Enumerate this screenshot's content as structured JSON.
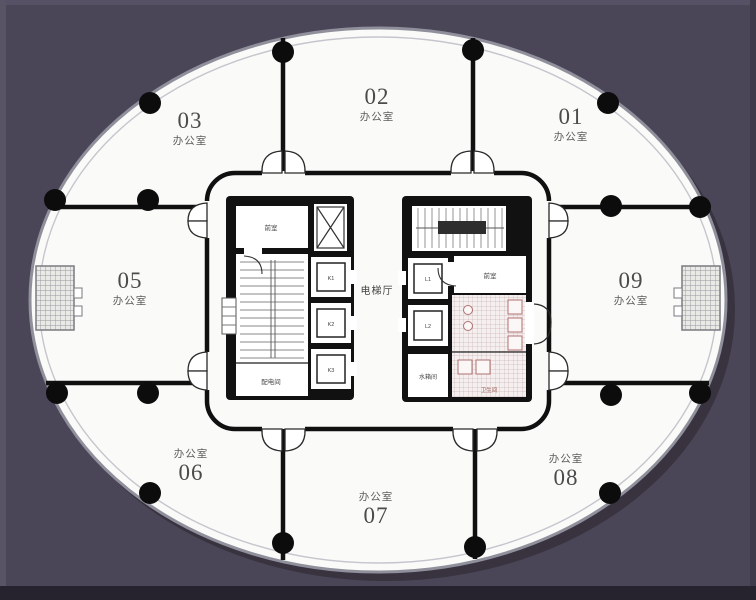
{
  "plan": {
    "rooms": [
      {
        "number": "01",
        "type_label": "办公室"
      },
      {
        "number": "02",
        "type_label": "办公室"
      },
      {
        "number": "03",
        "type_label": "办公室"
      },
      {
        "number": "05",
        "type_label": "办公室"
      },
      {
        "number": "06",
        "type_label": "办公室"
      },
      {
        "number": "07",
        "type_label": "办公室"
      },
      {
        "number": "08",
        "type_label": "办公室"
      },
      {
        "number": "09",
        "type_label": "办公室"
      }
    ],
    "core": {
      "elevator_hall_label": "电梯厅",
      "front_room_left_label": "前室",
      "front_room_right_label": "前室",
      "electrical_room_label": "配电间",
      "water_tank_room_label": "水箱间",
      "toilet_label": "卫生间",
      "left_lift_labels": [
        "K1",
        "K2",
        "K3"
      ],
      "right_lift_labels": [
        "L1",
        "L2"
      ]
    },
    "colors": {
      "background": "#4a4557",
      "floor": "#fafaf8",
      "wall": "#111111",
      "edge_ring": "#90909c",
      "column": "#0c0c0c",
      "toilet_accent": "#b07070"
    }
  }
}
